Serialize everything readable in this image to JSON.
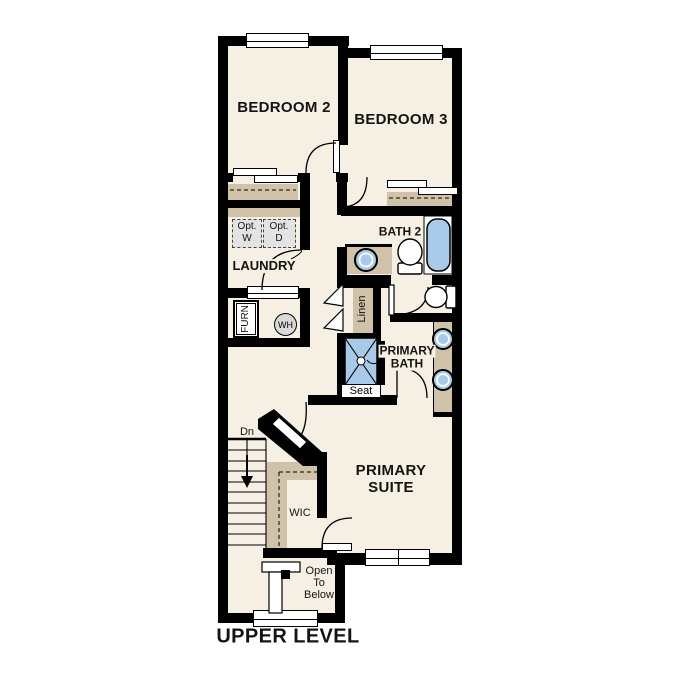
{
  "title": "UPPER LEVEL",
  "colors": {
    "floor": "#f6efe3",
    "walls": "#000000",
    "casework_tan": "#cfc2a9",
    "fixture_blue": "#a9c9e8",
    "appliance_gray": "#e3e3e3",
    "window_white": "#ffffff"
  },
  "rooms": {
    "bedroom2": "BEDROOM 2",
    "bedroom3": "BEDROOM 3",
    "bath2": "BATH 2",
    "laundry": "LAUNDRY",
    "primary_bath": {
      "line1": "PRIMARY",
      "line2": "BATH"
    },
    "primary_suite": {
      "line1": "PRIMARY",
      "line2": "SUITE"
    },
    "wic": "WIC",
    "linen": "Linen"
  },
  "fixtures": {
    "furnace": "FURN",
    "water_heater": "WH",
    "shower_seat": "Seat",
    "opt_washer": {
      "line1": "Opt.",
      "line2": "W"
    },
    "opt_dryer": {
      "line1": "Opt.",
      "line2": "D"
    }
  },
  "stairs": {
    "direction": "Dn"
  },
  "open_to_below": {
    "line1": "Open",
    "line2": "To",
    "line3": "Below"
  }
}
